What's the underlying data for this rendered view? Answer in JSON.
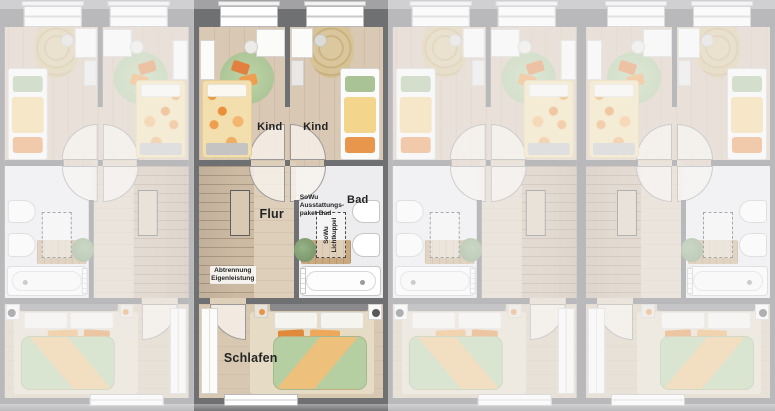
{
  "plan": {
    "type": "floor-plan-row-houses-upper-floor",
    "units_count": 4,
    "highlighted_unit": 2,
    "units": [
      {
        "name": "unit-1",
        "state": "dimmed",
        "orientation": "mirrored"
      },
      {
        "name": "unit-2",
        "state": "highlighted",
        "orientation": "normal"
      },
      {
        "name": "unit-3",
        "state": "dimmed",
        "orientation": "mirrored"
      },
      {
        "name": "unit-4",
        "state": "dimmed",
        "orientation": "normal"
      }
    ]
  },
  "labels": {
    "kind_left": "Kind",
    "kind_right": "Kind",
    "flur": "Flur",
    "bad": "Bad",
    "schlafen": "Schlafen",
    "sowu_line1": "SoWu",
    "sowu_line2": "Ausstattungs-",
    "sowu_line3": "paket Bad",
    "lichtkuppel_line1": "SoWu",
    "lichtkuppel_line2": "Lichtkuppel",
    "abtrennung_line1": "Abtrennung",
    "abtrennung_line2": "Eigenleistung"
  },
  "colors": {
    "wall": "#6f7072",
    "background": "#a2a2a4",
    "wood_floor": "#d9c8b3",
    "bath_floor": "#ededef",
    "stairs": "#cdbaa3",
    "rug_green": "#b4cc9e",
    "rug_jute": "#d9c59b",
    "duvet_green": "#b6cfa2",
    "duvet_orange": "#edc07c",
    "accent_orange": "#e8934a",
    "dim_overlay": "rgba(246,246,248,0.55)",
    "label_text": "#242424"
  }
}
